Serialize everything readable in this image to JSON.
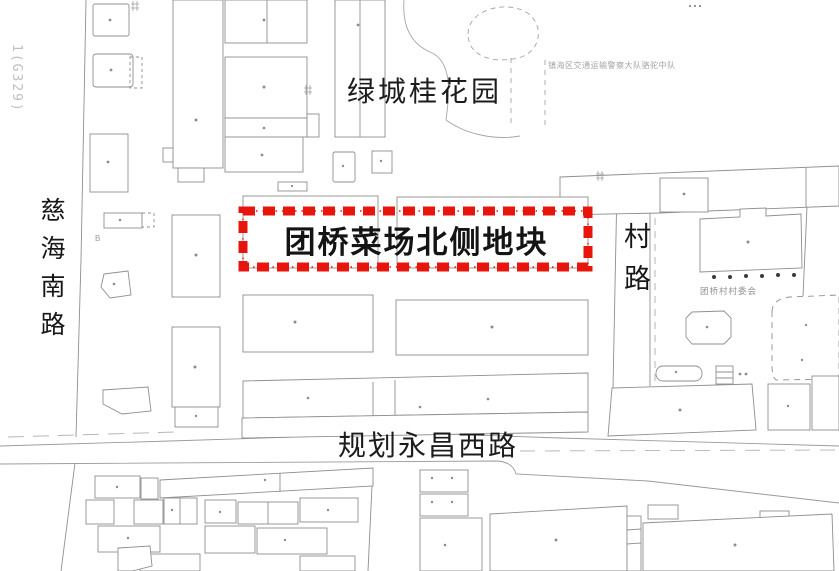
{
  "map": {
    "corner_code": "1(G329)",
    "plot": {
      "label": "团桥菜场北侧地块",
      "border_color": "#e8150d"
    },
    "roads": {
      "west": "慈海南路",
      "east": "村路",
      "south": "规划永昌西路"
    },
    "places": {
      "garden": "绿城桂花园",
      "police_station": "镇海区交通运输警察大队骆驼中队",
      "village_committee": "团桥村村委会",
      "b_mark": "B"
    },
    "colors": {
      "building_line": "#8a8a8a",
      "plot_border": "#e8150d",
      "faint_text": "#9e9e9e"
    }
  }
}
